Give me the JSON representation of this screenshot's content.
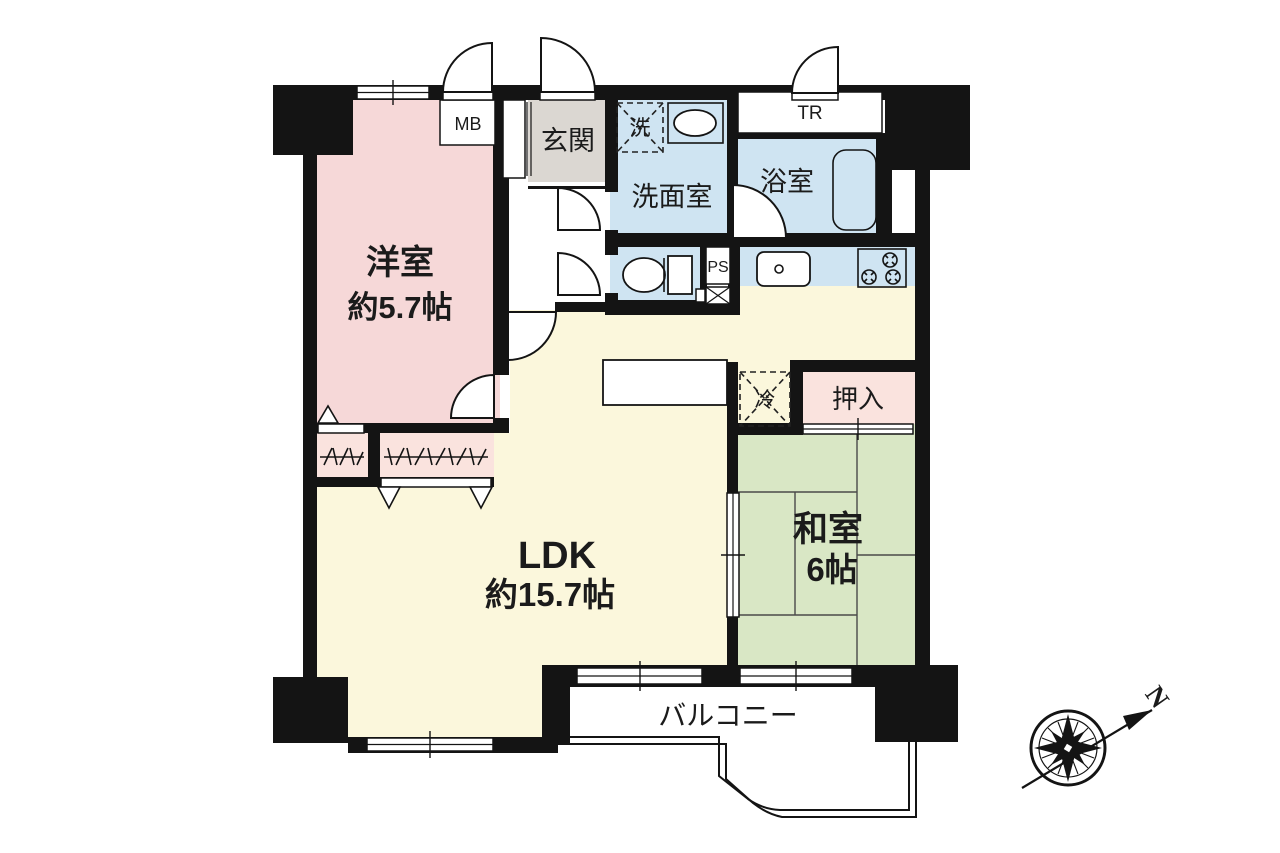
{
  "floorplan": {
    "rooms": {
      "western_room": {
        "name": "洋室",
        "size": "約5.7帖",
        "color": "#f6d8d8"
      },
      "ldk": {
        "name": "LDK",
        "size": "約15.7帖",
        "color": "#fbf7dc"
      },
      "japanese_room": {
        "name": "和室",
        "size": "6帖",
        "color": "#d9e7c5"
      },
      "entrance": {
        "name": "玄関",
        "color": "#dbd7d2"
      },
      "washroom": {
        "name": "洗面室",
        "color": "#cfe4f2"
      },
      "bathroom": {
        "name": "浴室",
        "color": "#cfe4f2"
      },
      "toilet": {
        "color": "#cfe4f2"
      },
      "kitchen": {
        "color": "#cfe4f2"
      },
      "closet": {
        "name": "押入",
        "color": "#fae3de"
      },
      "storage_closet": {
        "color": "#fae3de"
      },
      "balcony": {
        "name": "バルコニー"
      }
    },
    "annotations": {
      "meter_box": "MB",
      "trunk_room": "TR",
      "pipe_space": "PS",
      "washing_machine": "洗",
      "refrigerator": "冷"
    },
    "compass": {
      "north": "N"
    },
    "wall_color": "#141414"
  }
}
